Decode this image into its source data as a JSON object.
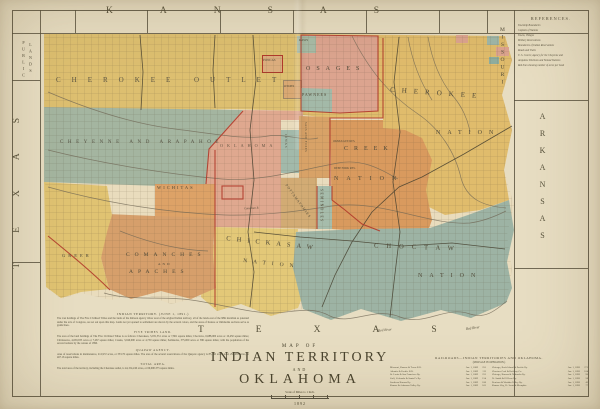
{
  "states": {
    "kansas": "KANSAS",
    "missouri": "MISSOURI",
    "arkansas": "ARKANSAS",
    "texas_w": "TEXAS",
    "texas_s": "TEXAS",
    "public": "PUBLIC",
    "lands": "LANDS"
  },
  "labels": {
    "outlet_a": "CHEROKEE",
    "outlet_b": "OUTLET",
    "cheyenne": "CHEYENNE AND ARAPAHOE",
    "osage": "OSAGES",
    "pawnee": "PAWNEES",
    "kaw": "KAWS",
    "otoe": "OTOES",
    "ponca": "PONCAS",
    "cherokee_a": "CHEROKEE",
    "cherokee_b": "NATION",
    "creek_a": "CREEK",
    "creek_b": "NATION",
    "okmulgee": "OKMULGEE RES.",
    "deepfork": "DEEP FORK RES.",
    "seminole": "SEMINOLES",
    "wichita": "WICHITAS",
    "comanche_a": "COMANCHES",
    "comanche_and": "AND",
    "comanche_b": "APACHES",
    "chickasaw_a": "CHICKASAW",
    "chickasaw_b": "NATION",
    "choctaw_a": "CHOCTAW",
    "choctaw_b": "NATION",
    "iowa": "IOWAS",
    "sacfox": "SACS AND FOXES",
    "pott": "POTTAWATOMIES",
    "greer": "GREER",
    "oklahoma": "OKLAHOMA",
    "red_river_a": "Red River",
    "red_river_b": "Red River",
    "canadian": "Canadian R."
  },
  "references": {
    "title": "REFERENCES.",
    "lines": [
      "Township Boundaries",
      "Capitals of Nations",
      "Towns, Villages",
      "Military Reservations",
      "Boundaries of Indian Reservations",
      "Roads and Trails",
      "U. S. Courts; Agency for the Cheyenne and",
      "Arapahoe Divisions and Nomad Stations",
      "Red lines showing number of acres per head"
    ]
  },
  "title_block": {
    "map_of": "MAP OF",
    "territory": "INDIAN TERRITORY",
    "conj": "AND",
    "oklahoma": "OKLAHOMA",
    "scale": "Scale of Miles to 1 Inch.",
    "year": "1892"
  },
  "notes": {
    "h1": "INDIAN TERRITORY.",
    "date": "(JUNE 1, 1891.)",
    "p1": "The vast holdings of The Five Civilized Tribes and the lands of the thirteen agency tribes west of the original Indian territory, all of the lands east of the 98th meridian as patented under the acts of Congress, are set out upon this map. Lands not yet opened to settlement are shown by the several colors, and the areas of Kansas or Oklahoma sections serve as guide lines.",
    "h2": "FIVE TRIBES LAND.",
    "p2": "The area of the land holdings of The Five Civilized Tribes is as follows: Cherokees, 5,031,351 acres or 7,861 square miles; Choctaws, 6,688,000 acres or 10,450 square miles; Chickasaws, 4,650,935 acres or 7,267 square miles; Creeks, 3,040,000 acres or 4,750 square miles; Seminoles, 375,000 acres or 586 square miles; with the population of the several nations by the census of 1890.",
    "h3": "QUAPAW AGENCY.",
    "p3": "Area of reservations in maintenance, 212,972 acres, or 333.76 square miles. The area of the several reservations of the Quapaw agency is 85,166 acres; total, 298,983 acres, or 467.16 square miles.",
    "h4": "TOTAL AREA.",
    "p4": "The total area of the territory, including the Cherokee outlet, is 44,154,240 acres, or 69,000.375 square miles."
  },
  "railroads": {
    "title": "RAILROADS—INDIAN TERRITORIES AND OKLAHOMA.",
    "subtitle": "(MILEAGE IN OPERATION.)",
    "left": [
      {
        "n": "Missouri, Kansas & Texas R.R.",
        "d": "Jan. 1, 1889",
        "m": "255"
      },
      {
        "n": "Atlantic & Pacific R.R.",
        "d": "Jan. 1, 1889",
        "m": "112"
      },
      {
        "n": "St. Louis & San Francisco Ry.",
        "d": "Jan. 1, 1889",
        "m": "231"
      },
      {
        "n": "Gulf, Colorado & Santa Fe Ry.",
        "d": "Jan. 1, 1889",
        "m": "154"
      },
      {
        "n": "Southern Kansas Ry.",
        "d": "Jan. 1, 1889",
        "m": "186"
      },
      {
        "n": "Kansas & Arkansas Valley Ry.",
        "d": "Jan. 1, 1889",
        "m": "165"
      }
    ],
    "right": [
      {
        "n": "Chicago, Rock Island & Pacific Ry.",
        "d": "Jan. 1, 1890",
        "m": "271"
      },
      {
        "n": "Choctaw Coal & Railway Co.",
        "d": "Jan. 1, 1890",
        "m": "104"
      },
      {
        "n": "Chicago, Kansas & Nebraska Ry.",
        "d": "Jan. 1, 1890",
        "m": "96"
      },
      {
        "n": "Ft. Smith & El Reno Ry.",
        "d": "Jan. 1, 1890",
        "m": "58"
      },
      {
        "n": "Denison & Washita Valley Ry.",
        "d": "Jan. 1, 1890",
        "m": "42"
      },
      {
        "n": "Kansas City, Ft. Scott & Memphis",
        "d": "Jan. 1, 1890",
        "m": "77"
      }
    ]
  }
}
